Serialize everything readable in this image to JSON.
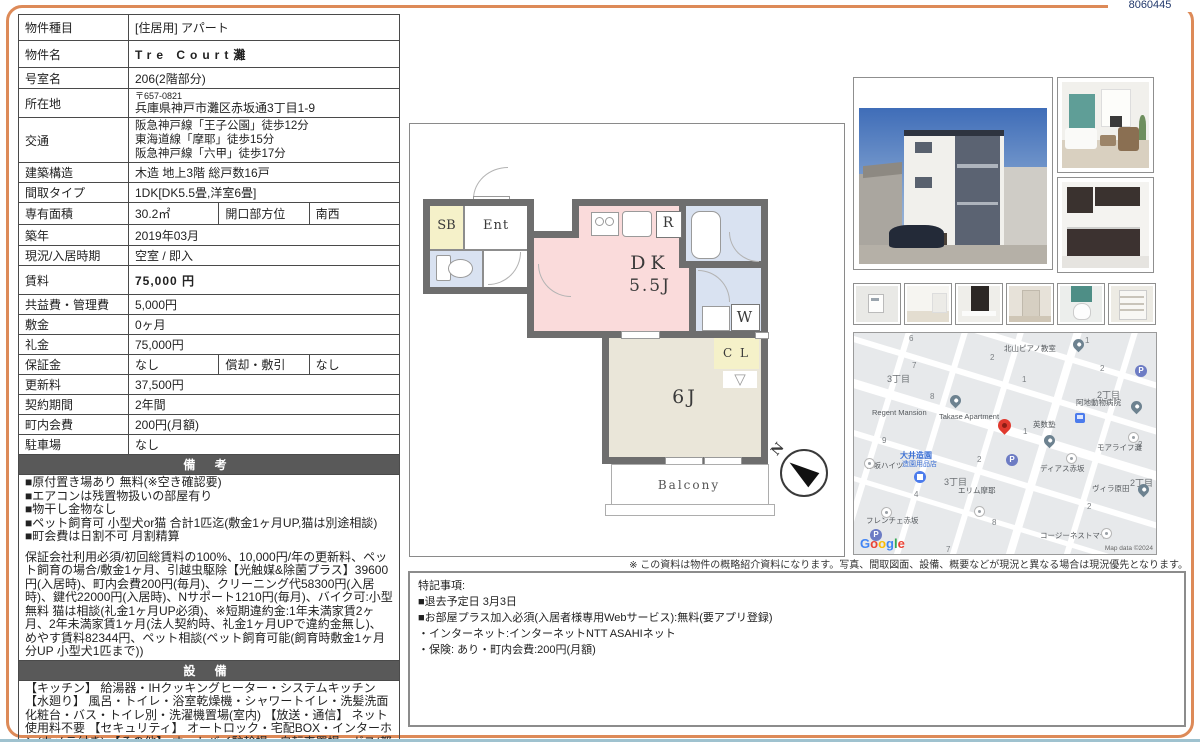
{
  "doc_number": "8060445",
  "colors": {
    "frame": "#dd8a58",
    "section_header": "#595959",
    "navy": "#21386b",
    "dk_pink": "#fadbdb",
    "room_beige": "#eae6d9",
    "wet_blue": "#d9e2f1",
    "closet_yellow": "#f5f1c9",
    "red_pin": "#e0392e"
  },
  "property_table": {
    "rows": [
      {
        "label": "物件種目",
        "value": "[住居用] アパート"
      },
      {
        "label": "物件名",
        "value": "Tre Court灘"
      },
      {
        "label": "号室名",
        "value": "206(2階部分)"
      },
      {
        "label": "所在地",
        "postal": "〒657-0821",
        "value": "兵庫県神戸市灘区赤坂通3丁目1-9"
      },
      {
        "label": "交通",
        "lines": [
          "阪急神戸線「王子公園」徒歩12分",
          "東海道線「摩耶」徒歩15分",
          "阪急神戸線「六甲」徒歩17分"
        ]
      },
      {
        "label": "建築構造",
        "value": "木造 地上3階 総戸数16戸"
      },
      {
        "label": "間取タイプ",
        "value": "1DK[DK5.5畳,洋室6畳]"
      },
      {
        "label": "専有面積",
        "value": "30.2㎡",
        "label2": "開口部方位",
        "value2": "南西"
      },
      {
        "label": "築年",
        "value": "2019年03月"
      },
      {
        "label": "現況/入居時期",
        "value": "空室 / 即入"
      },
      {
        "label": "賃料",
        "value": "75,000 円"
      },
      {
        "label": "共益費・管理費",
        "value": "5,000円"
      },
      {
        "label": "敷金",
        "value": "0ヶ月"
      },
      {
        "label": "礼金",
        "value": "75,000円"
      },
      {
        "label": "保証金",
        "value": "なし",
        "label2": "償却・敷引",
        "value2": "なし"
      },
      {
        "label": "更新料",
        "value": "37,500円"
      },
      {
        "label": "契約期間",
        "value": "2年間"
      },
      {
        "label": "町内会費",
        "value": "200円(月額)"
      },
      {
        "label": "駐車場",
        "value": "なし"
      }
    ]
  },
  "remarks": {
    "title": "備 考",
    "bullets": [
      "■原付置き場あり 無料(※空き確認要)",
      "■エアコンは残置物扱いの部屋有り",
      "■物干し金物なし",
      "■ペット飼育可 小型犬or猫 合計1匹迄(敷金1ヶ月UP,猫は別途相談)",
      "■町会費は日割不可 月割精算"
    ],
    "paragraph": "保証会社利用必須/初回総賃料の100%、10,000円/年の更新料、ペット飼育の場合/敷金1ヶ月、引越虫駆除【光触媒&除菌プラス】39600円(入居時)、町内会費200円(毎月)、クリーニング代58300円(入居時)、鍵代22000円(入居時)、Nサポート1210円(毎月)、バイク可:小型無料 猫は相談(礼金1ヶ月UP必須)、※短期違約金:1年未満家賃2ヶ月、2年未満家賃1ヶ月(法人契約時、礼金1ヶ月UPで違約金無し)、めやす賃料82344円、ペット相談(ペット飼育可能(飼育時敷金1ヶ月分UP 小型犬1匹まで))"
  },
  "equipment": {
    "title": "設 備",
    "text": "【キッチン】 給湯器・IHクッキングヒーター・システムキッチン 【水廻り】 風呂・トイレ・浴室乾燥機・シャワートイレ・洗髪洗面化粧台・バス・トイレ別・洗濯機置場(室内) 【放送・通信】 ネット使用料不要 【セキュリティ】 オートロック・宅配BOX・インターホン(カメラ付き) 【その他】 オートバイ駐輪場・自転車置場・ガス(都市ガス)・水道(公営)・排水(公共下水)・バルコニー/ベランダ・フローリング"
  },
  "floorplan": {
    "sb": "SB",
    "ent": "Ent",
    "r": "R",
    "dk_line1": "DK",
    "dk_line2": "5.5J",
    "w": "W",
    "cl": "C L",
    "room6": "6J",
    "balcony": "Balcony",
    "north": "N"
  },
  "photos": {
    "names": [
      "building-exterior",
      "living-room",
      "kitchen",
      "intercom-panel",
      "bright-room",
      "kitchen-closeup",
      "hallway-door",
      "toilet",
      "storage-shelves"
    ]
  },
  "map": {
    "texts": [
      {
        "t": "6",
        "x": 55,
        "y": 1,
        "k": "mn"
      },
      {
        "t": "2",
        "x": 136,
        "y": 20,
        "k": "mn"
      },
      {
        "t": "1",
        "x": 231,
        "y": 3,
        "k": "mn"
      },
      {
        "t": "7",
        "x": 58,
        "y": 28,
        "k": "mn"
      },
      {
        "t": "2",
        "x": 246,
        "y": 31,
        "k": "mn"
      },
      {
        "t": "1",
        "x": 168,
        "y": 42,
        "k": "mn"
      },
      {
        "t": "8",
        "x": 76,
        "y": 59,
        "k": "mn"
      },
      {
        "t": "9",
        "x": 28,
        "y": 103,
        "k": "mn"
      },
      {
        "t": "1",
        "x": 169,
        "y": 94,
        "k": "mn"
      },
      {
        "t": "2",
        "x": 123,
        "y": 122,
        "k": "mn"
      },
      {
        "t": "2",
        "x": 284,
        "y": 107,
        "k": "mn"
      },
      {
        "t": "4",
        "x": 60,
        "y": 157,
        "k": "mn"
      },
      {
        "t": "2",
        "x": 233,
        "y": 169,
        "k": "mn"
      },
      {
        "t": "8",
        "x": 138,
        "y": 185,
        "k": "mn"
      },
      {
        "t": "7",
        "x": 92,
        "y": 212,
        "k": "mn"
      },
      {
        "t": "3丁目",
        "x": 33,
        "y": 39,
        "k": "md"
      },
      {
        "t": "2丁目",
        "x": 243,
        "y": 55,
        "k": "md"
      },
      {
        "t": "3丁目",
        "x": 90,
        "y": 142,
        "k": "md"
      },
      {
        "t": "2丁目",
        "x": 276,
        "y": 143,
        "k": "md"
      },
      {
        "t": "北山ピアノ教室",
        "x": 150,
        "y": 10,
        "k": "mp"
      },
      {
        "t": "阿地動物病院",
        "x": 222,
        "y": 64,
        "k": "mp"
      },
      {
        "t": "Regent Mansion",
        "x": 18,
        "y": 75,
        "k": "mp"
      },
      {
        "t": "Takase Apartment",
        "x": 85,
        "y": 79,
        "k": "mp"
      },
      {
        "t": "英数塾",
        "x": 179,
        "y": 86,
        "k": "mp"
      },
      {
        "t": "モアライフ灘",
        "x": 243,
        "y": 109,
        "k": "mp"
      },
      {
        "t": "ディアス赤坂",
        "x": 186,
        "y": 130,
        "k": "mp"
      },
      {
        "t": "赤坂ハイツ",
        "x": 12,
        "y": 127,
        "k": "mp"
      },
      {
        "t": "エリム摩耶",
        "x": 104,
        "y": 152,
        "k": "mp"
      },
      {
        "t": "ヴィラ原田",
        "x": 238,
        "y": 150,
        "k": "mp"
      },
      {
        "t": "フレンチェ赤坂",
        "x": 12,
        "y": 182,
        "k": "mp"
      },
      {
        "t": "コージーネストマヤ",
        "x": 186,
        "y": 197,
        "k": "mp"
      },
      {
        "t": "大井造園",
        "x": 46,
        "y": 117,
        "k": "mb"
      },
      {
        "t": "造園用品店",
        "x": 48,
        "y": 126,
        "k": "mb2"
      }
    ],
    "pins": [
      {
        "x": 219,
        "y": 6,
        "k": "pin-poi"
      },
      {
        "x": 96,
        "y": 62,
        "k": "pin-poi"
      },
      {
        "x": 277,
        "y": 68,
        "k": "pin-poi"
      },
      {
        "x": 190,
        "y": 102,
        "k": "pin-poi"
      },
      {
        "x": 284,
        "y": 151,
        "k": "pin-poi"
      },
      {
        "x": 274,
        "y": 99,
        "k": "pin-wh"
      },
      {
        "x": 212,
        "y": 120,
        "k": "pin-wh"
      },
      {
        "x": 10,
        "y": 125,
        "k": "pin-wh"
      },
      {
        "x": 120,
        "y": 173,
        "k": "pin-wh"
      },
      {
        "x": 27,
        "y": 174,
        "k": "pin-wh"
      },
      {
        "x": 247,
        "y": 195,
        "k": "pin-wh"
      },
      {
        "x": 281,
        "y": 32,
        "k": "pin-p",
        "t": "P"
      },
      {
        "x": 152,
        "y": 121,
        "k": "pin-p",
        "t": "P"
      },
      {
        "x": 16,
        "y": 196,
        "k": "pin-p",
        "t": "P"
      },
      {
        "x": 144,
        "y": 86,
        "k": "pin-red"
      },
      {
        "x": 60,
        "y": 138,
        "k": "pin-store"
      },
      {
        "x": 221,
        "y": 80,
        "k": "pin-bus"
      }
    ],
    "google": "Google",
    "attribution": "Map data ©2024"
  },
  "disclaimer": "※ この資料は物件の概略紹介資料になります。写真、間取図面、設備、概要などが現況と異なる場合は現況優先となります。",
  "special_notes": {
    "lines": [
      "特記事項:",
      "■退去予定日 3月3日",
      "■お部屋プラス加入必須(入居者様専用Webサービス):無料(要アプリ登録)",
      "・インターネット:インターネットNTT ASAHIネット",
      "・保険: あり・町内会費:200円(月額)"
    ]
  }
}
